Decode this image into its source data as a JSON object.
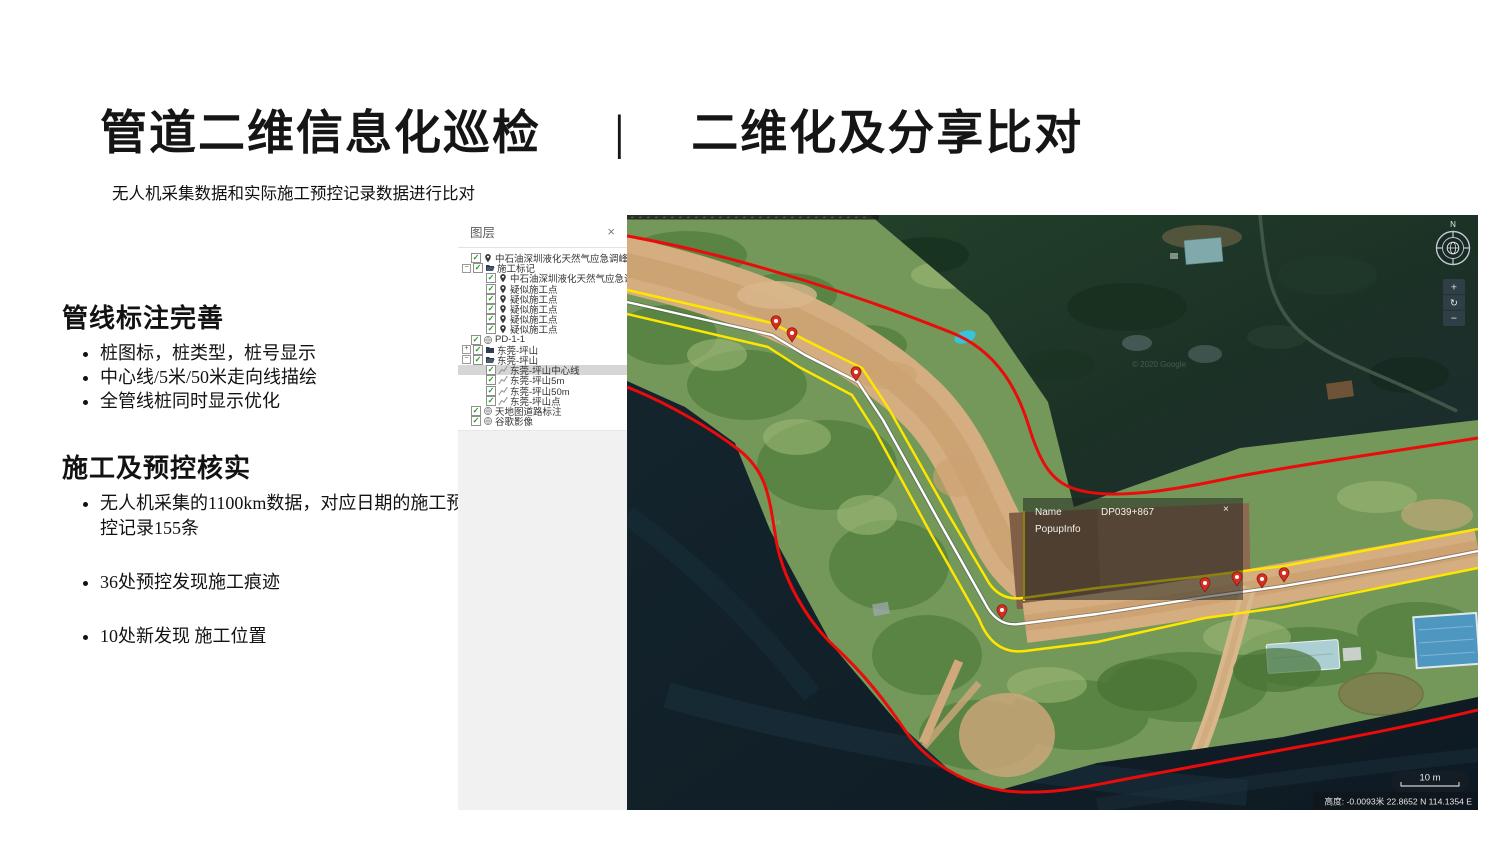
{
  "slide": {
    "title_left": "管道二维信息化巡检",
    "title_separator": "|",
    "title_right": "二维化及分享比对",
    "subtitle": "无人机采集数据和实际施工预控记录数据进行比对"
  },
  "sections": [
    {
      "heading": "管线标注完善",
      "bullets": [
        "桩图标，桩类型，桩号显示",
        "中心线/5米/50米走向线描绘",
        "全管线桩同时显示优化"
      ]
    },
    {
      "heading": "施工及预控核实",
      "bullets": [
        "无人机采集的1100km数据，对应日期的施工预控记录155条",
        "36处预控发现施工痕迹",
        "10处新发现 施工位置"
      ]
    }
  ],
  "layers_panel": {
    "title": "图层",
    "close_icon": "×",
    "items": [
      {
        "indent": 1,
        "toggle": null,
        "checked": true,
        "icon": "pin",
        "label": "中石油深圳液化天然气应急调峰站...",
        "selected": false
      },
      {
        "indent": 0,
        "toggle": "minus",
        "checked": true,
        "icon": "folder-open",
        "label": "施工标记",
        "selected": false
      },
      {
        "indent": 2,
        "toggle": null,
        "checked": true,
        "icon": "pin",
        "label": "中石油深圳液化天然气应急调峰...",
        "selected": false
      },
      {
        "indent": 2,
        "toggle": null,
        "checked": true,
        "icon": "pin",
        "label": "疑似施工点",
        "selected": false
      },
      {
        "indent": 2,
        "toggle": null,
        "checked": true,
        "icon": "pin",
        "label": "疑似施工点",
        "selected": false
      },
      {
        "indent": 2,
        "toggle": null,
        "checked": true,
        "icon": "pin",
        "label": "疑似施工点",
        "selected": false
      },
      {
        "indent": 2,
        "toggle": null,
        "checked": true,
        "icon": "pin",
        "label": "疑似施工点",
        "selected": false
      },
      {
        "indent": 2,
        "toggle": null,
        "checked": true,
        "icon": "pin",
        "label": "疑似施工点",
        "selected": false
      },
      {
        "indent": 1,
        "toggle": null,
        "checked": true,
        "icon": "globe",
        "label": "PD-1-1",
        "selected": false
      },
      {
        "indent": 0,
        "toggle": "plus",
        "checked": true,
        "icon": "folder",
        "label": "东莞-坪山",
        "selected": false
      },
      {
        "indent": 0,
        "toggle": "minus",
        "checked": true,
        "icon": "folder-open",
        "label": "东莞-坪山",
        "selected": false
      },
      {
        "indent": 2,
        "toggle": null,
        "checked": true,
        "icon": "polyline",
        "label": "东莞-坪山中心线",
        "selected": true
      },
      {
        "indent": 2,
        "toggle": null,
        "checked": true,
        "icon": "polyline",
        "label": "东莞-坪山5m",
        "selected": false
      },
      {
        "indent": 2,
        "toggle": null,
        "checked": true,
        "icon": "polyline",
        "label": "东莞-坪山50m",
        "selected": false
      },
      {
        "indent": 2,
        "toggle": null,
        "checked": true,
        "icon": "polyline",
        "label": "东莞-坪山点",
        "selected": false
      },
      {
        "indent": 1,
        "toggle": null,
        "checked": true,
        "icon": "globe",
        "label": "天地图道路标注",
        "selected": false
      },
      {
        "indent": 1,
        "toggle": null,
        "checked": true,
        "icon": "globe",
        "label": "谷歌影像",
        "selected": false
      }
    ]
  },
  "map": {
    "popup": {
      "name_label": "Name",
      "name_value": "DP039+867",
      "info_label": "PopupInfo",
      "close_icon": "×"
    },
    "scale_bar_label": "10 m",
    "status_bar": "高度:  -0.0093米 22.8652 N 114.1354 E",
    "compass_label": "N",
    "zoom_controls": {
      "zoom_in": "+",
      "reset": "↻",
      "zoom_out": "−"
    },
    "watermark": "© 2020 Google"
  },
  "colors": {
    "line_red": "#ea0b0b",
    "line_yellow": "#ffe600",
    "line_white": "#ffffff",
    "pin_red": "#d62e23",
    "check_green": "#1f9b1f",
    "panel_selected_bg": "#d6d6d6"
  }
}
